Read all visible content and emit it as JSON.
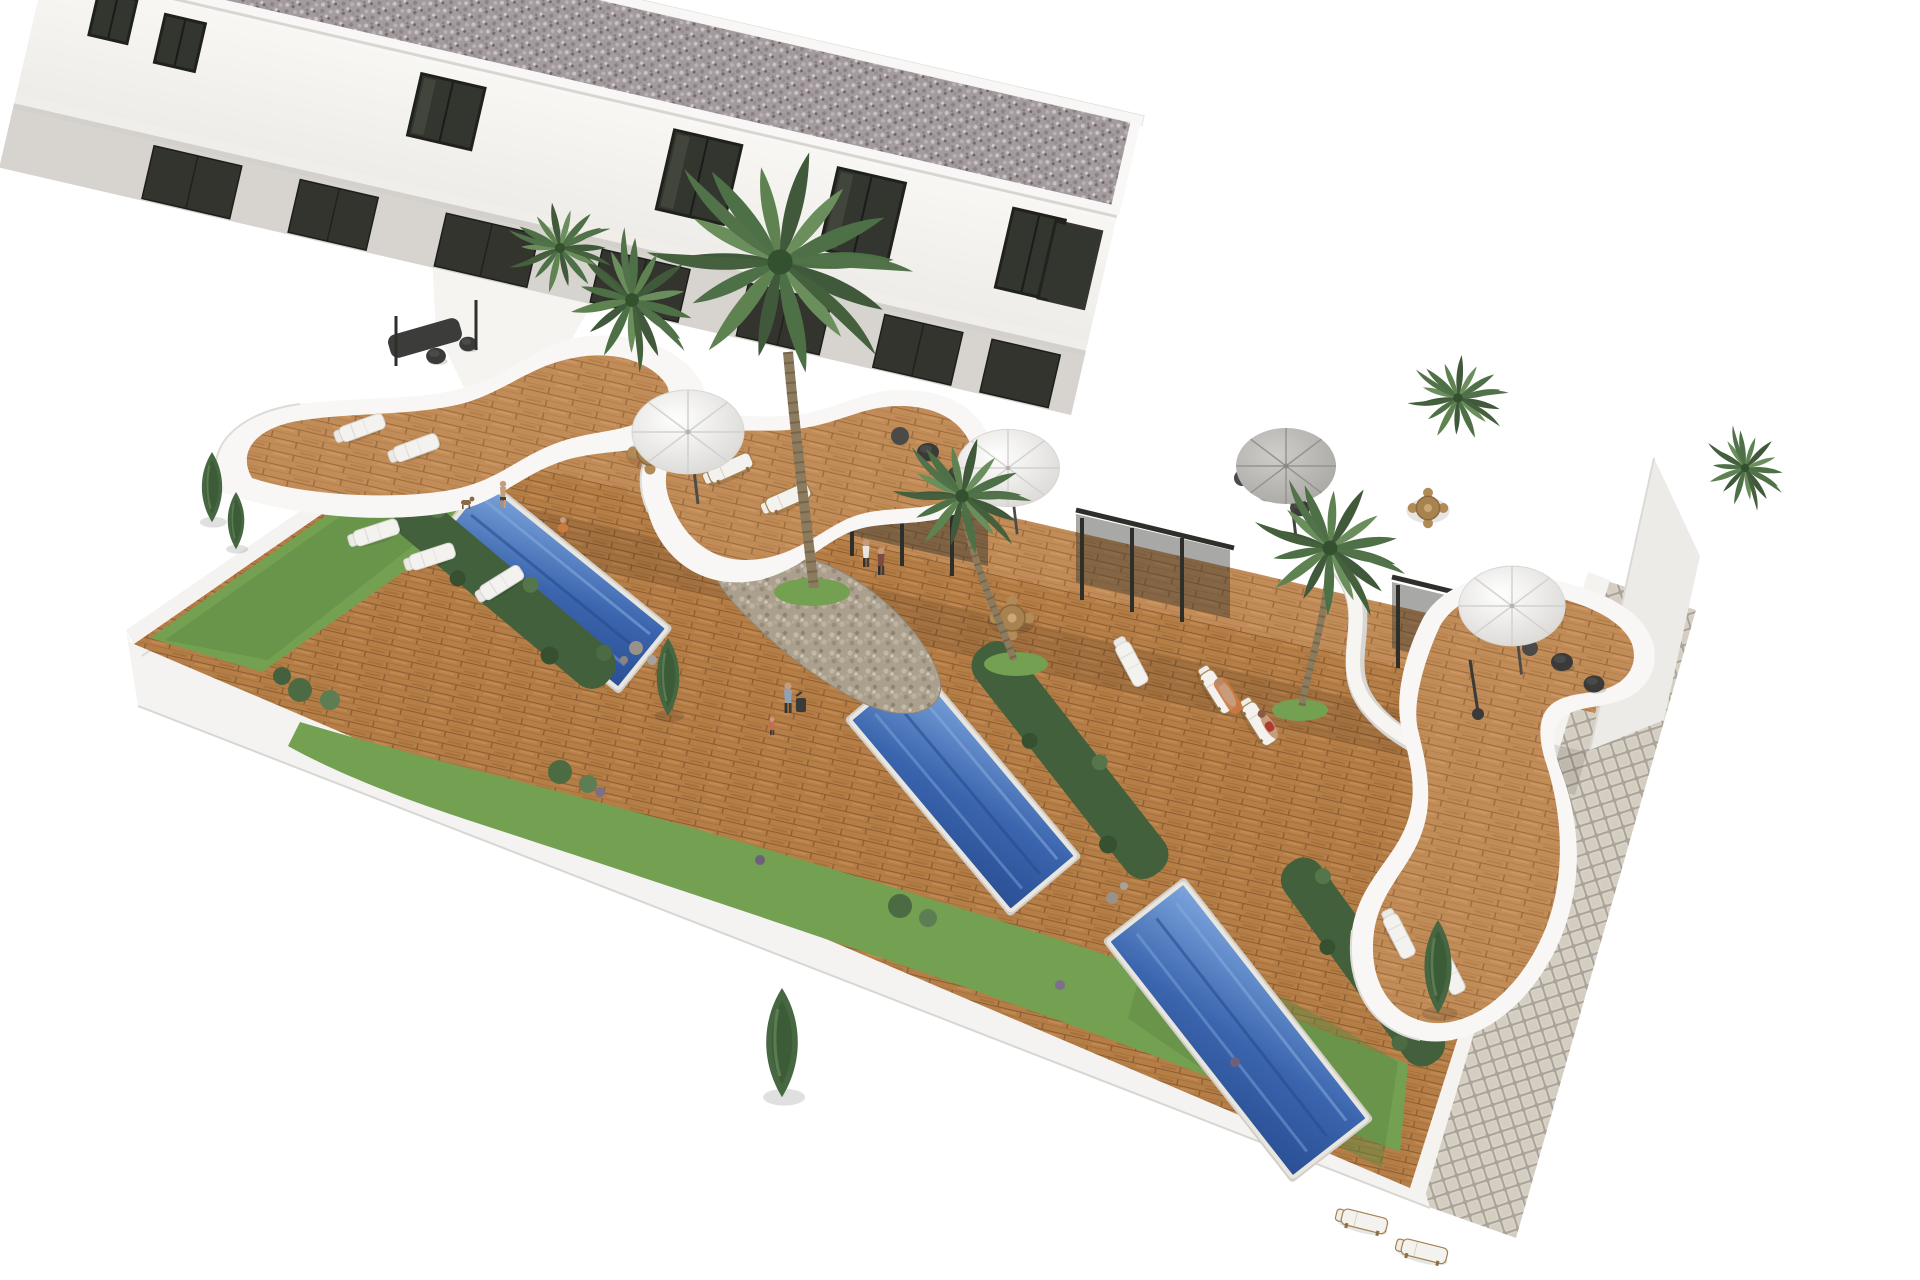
{
  "scene": {
    "title": "Aerial 3D architectural rendering of a modern white townhouse row with private blue pools, wooden deck gardens, curved white roof terraces, palm trees and a cobblestone side path on a white background",
    "type": "architectural-3d-render",
    "view": "aerial oblique, building running diagonally from upper-left to right",
    "background": "#ffffff"
  },
  "palette": {
    "bg": "#ffffff",
    "wall_white": "#f4f3f1",
    "wall_top": "#fdfdfc",
    "wall_end": "#edebe7",
    "wall_shadow": "#d8d6d2",
    "parapet": "#f8f7f5",
    "roof_base": "#a39b9e",
    "facade_top": "#f8f7f4",
    "facade_bottom": "#e8e6e2",
    "slab": "#f0eeea",
    "recess": "#d7d4cf",
    "window_frame": "#20201d",
    "window_glass": "#32362e",
    "ground_glass": "#34342f",
    "deck_wood": "#c18c57",
    "deck_wood_ground": "#b67e47",
    "plank_line": "#9b6b3d",
    "pool_light": "#7da6dd",
    "pool_mid": "#3a64ad",
    "pool_deep": "#2a4f94",
    "pool_coping": "#e9e6e0",
    "grass": "#74a052",
    "grass_dark": "#5d8742",
    "hedge": "#42603b",
    "hedge_light": "#55764a",
    "cypress": "#466741",
    "palm_dark": "#40593a",
    "palm_mid": "#4e7046",
    "palm_light": "#6b8f5c",
    "trunk": "#8d7b5e",
    "stone_base": "#ab9f8e",
    "cobble_grout": "#aaa399",
    "cobble_tile": "#d9d2c6",
    "furniture_dark": "#3a3a38",
    "lounger_white": "#f3f2ef",
    "parasol_white": "#f2f1ee",
    "parasol_gray": "#bdbbb7",
    "pole_dark": "#4e4c49",
    "skin": "#c79c7d"
  },
  "building": {
    "storeys": 2,
    "roof": "flat gravel roof with white parapet and one white chimney box",
    "upper_window_count": 7,
    "ground_glass_door_count": 7,
    "end_wall": "white with small dark slit window"
  },
  "units": [
    {
      "name": "townhouse-1",
      "features": [
        "curved white balcony terrace with wood deck",
        "stone clad curved wall",
        "ground deck with loungers",
        "private pool",
        "garden with cypresses"
      ]
    },
    {
      "name": "townhouse-2",
      "features": [
        "large S-curved white terrace with wood deck",
        "white parasol",
        "stone clad wall",
        "round dining set",
        "private pool"
      ]
    },
    {
      "name": "townhouse-3",
      "features": [
        "upper terrace with gray parasol and dark lounge furniture",
        "patio with sun loungers and sunbathers",
        "private pool"
      ]
    },
    {
      "name": "townhouse-4",
      "features": [
        "teardrop curved white roof terrace with white parasol",
        "dark bean bags",
        "ground patio with loungers",
        "lawn garden"
      ]
    }
  ],
  "pools": [
    {
      "id": "pool-1",
      "shape": "rectangular",
      "water": "blue with lane reflections"
    },
    {
      "id": "pool-2",
      "shape": "rectangular",
      "water": "blue with lane reflections"
    },
    {
      "id": "pool-3",
      "shape": "rectangular",
      "water": "blue with lane reflections"
    }
  ],
  "vegetation": {
    "palm_trees": 6,
    "cypress_trees": 5,
    "hedges": 3,
    "bushes": "several along the front wall with small purple accents",
    "lawn_areas": 3
  },
  "furniture": {
    "sun_loungers": 13,
    "white_parasols": 3,
    "gray_parasols": 1,
    "dining_sets": 3,
    "dark_bean_bags": 6,
    "pergolas": 3
  },
  "people": [
    {
      "id": "couple-on-terrace",
      "desc": "two people standing on the second terrace"
    },
    {
      "id": "person-with-luggage",
      "desc": "person pulling a dark suitcase on the deck"
    },
    {
      "id": "child-near-luggage",
      "desc": "small child beside the suitcase"
    },
    {
      "id": "person-by-pool",
      "desc": "person standing near the first pool"
    },
    {
      "id": "person-crouching",
      "desc": "crouching person in orange near the first pool"
    },
    {
      "id": "sunbather-1",
      "desc": "sunbather on lounger with orange towel"
    },
    {
      "id": "sunbather-2",
      "desc": "second sunbather on lounger"
    }
  ],
  "animals": [
    {
      "id": "dog",
      "desc": "small brown dog on the deck"
    }
  ],
  "site": {
    "perimeter": "white boundary wall on left and front",
    "path": "light cobblestone tiled walkway running diagonally at the right"
  }
}
